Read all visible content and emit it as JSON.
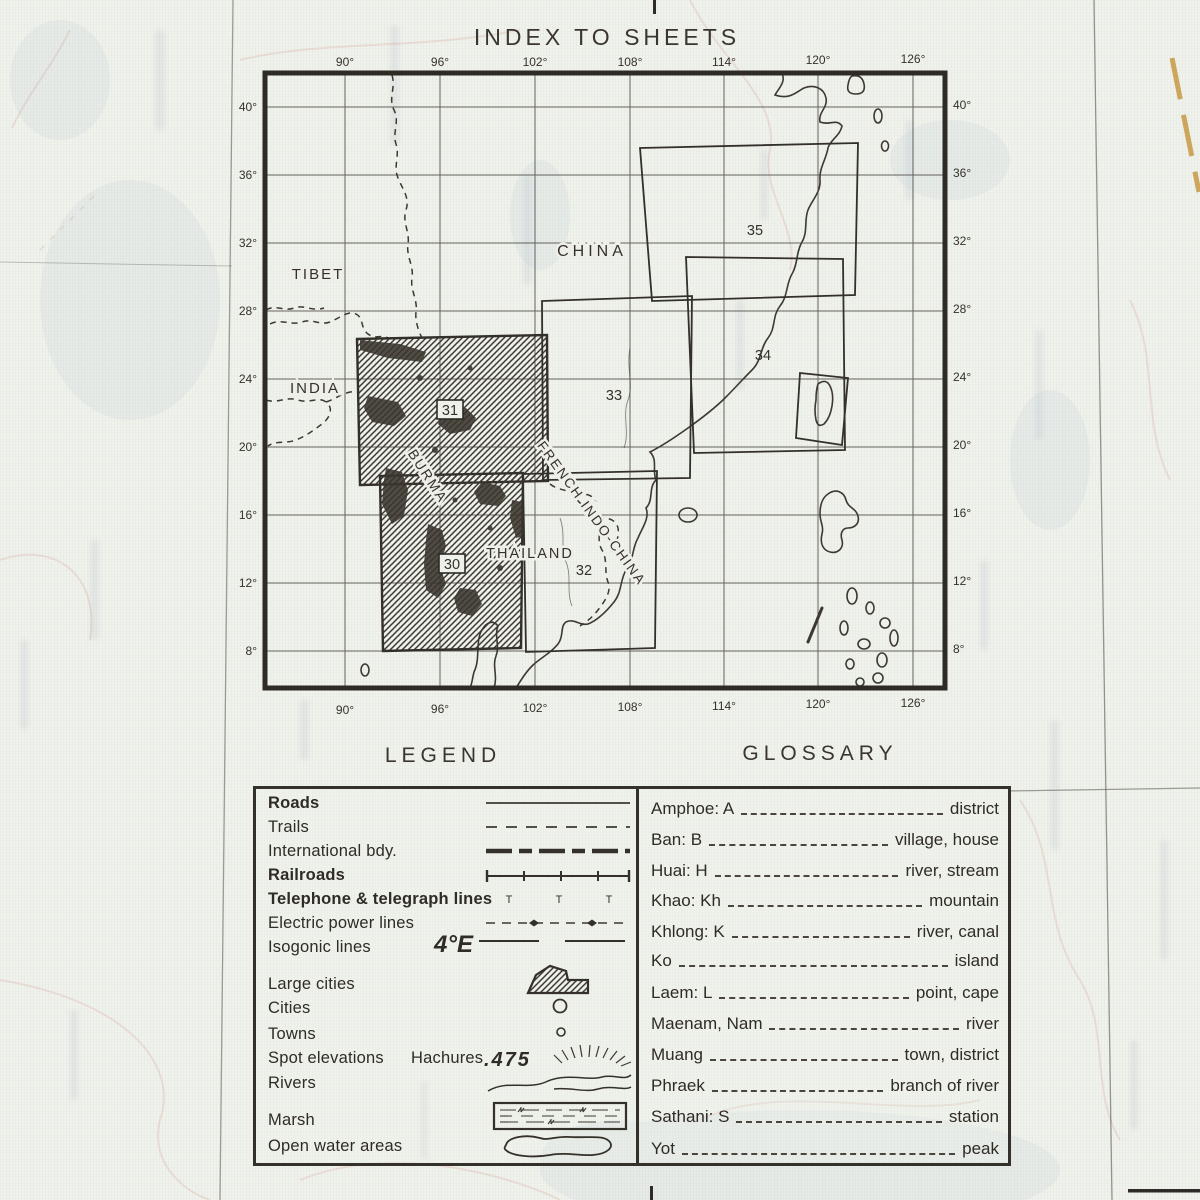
{
  "title": "INDEX TO SHEETS",
  "map": {
    "top_lon": [
      "90°",
      "96°",
      "102°",
      "108°",
      "114°",
      "120°",
      "126°"
    ],
    "bottom_lon": [
      "90°",
      "96°",
      "102°",
      "108°",
      "114°",
      "120°",
      "126°"
    ],
    "left_lat": [
      "40°",
      "36°",
      "32°",
      "28°",
      "24°",
      "20°",
      "16°",
      "12°",
      "8°"
    ],
    "right_lat": [
      "40°",
      "36°",
      "32°",
      "28°",
      "24°",
      "20°",
      "16°",
      "12°",
      "8°"
    ],
    "regions": {
      "tibet": "TIBET",
      "china": "CHINA",
      "india": "INDIA",
      "burma": "BURMA",
      "thailand": "THAILAND",
      "french_indo_china": "FRENCH INDO-CHINA"
    },
    "sheets": {
      "s30": "30",
      "s31": "31",
      "s32": "32",
      "s33": "33",
      "s34": "34",
      "s35": "35"
    }
  },
  "legend": {
    "heading": "LEGEND",
    "items": [
      {
        "label": "Roads"
      },
      {
        "label": "Trails"
      },
      {
        "label": "International bdy."
      },
      {
        "label": "Railroads"
      },
      {
        "label": "Telephone & telegraph lines"
      },
      {
        "label": "Electric power lines"
      },
      {
        "label": "Isogonic lines"
      },
      {
        "label": "Large cities"
      },
      {
        "label": "Cities"
      },
      {
        "label": "Towns"
      },
      {
        "label": "Spot elevations"
      },
      {
        "label": "Rivers"
      },
      {
        "label": "Marsh"
      },
      {
        "label": "Open water areas"
      }
    ],
    "hachures_label": "Hachures",
    "isogonic_value": "4°E",
    "spot_elevation_value": ".475",
    "telephone_glyph": "T"
  },
  "glossary": {
    "heading": "GLOSSARY",
    "entries": [
      {
        "term": "Amphoe: A",
        "definition": "district"
      },
      {
        "term": "Ban: B",
        "definition": "village, house"
      },
      {
        "term": "Huai: H",
        "definition": "river, stream"
      },
      {
        "term": "Khao: Kh",
        "definition": "mountain"
      },
      {
        "term": "Khlong: K",
        "definition": "river, canal"
      },
      {
        "term": "Ko",
        "definition": "island"
      },
      {
        "term": "Laem: L",
        "definition": "point, cape"
      },
      {
        "term": "Maenam, Nam",
        "definition": "river"
      },
      {
        "term": "Muang",
        "definition": "town, district"
      },
      {
        "term": "Phraek",
        "definition": "branch of river"
      },
      {
        "term": "Sathani: S",
        "definition": "station"
      },
      {
        "term": "Yot",
        "definition": "peak"
      }
    ]
  },
  "colors": {
    "ink": "#35312a",
    "paper": "#eef0ea",
    "accent_orange": "#c89a45",
    "faint_red": "#c26a55",
    "faint_blue": "#9db4c8"
  }
}
